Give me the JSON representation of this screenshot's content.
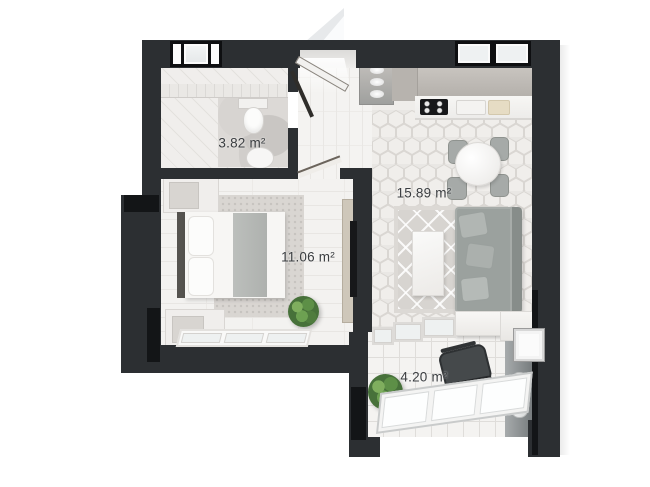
{
  "plan": {
    "type": "apartment-floor-plan",
    "rooms": [
      {
        "id": "bathroom",
        "area_label": "3.82 m²"
      },
      {
        "id": "kitchen-living",
        "area_label": "15.89 m²"
      },
      {
        "id": "bedroom",
        "area_label": "11.06 m²"
      },
      {
        "id": "balcony",
        "area_label": "4.20 m²"
      }
    ],
    "colors": {
      "wall": "#2c2f32",
      "wall_accent_black": "#131517",
      "floor_light": "#f2f1ef",
      "sofa_gray": "#9ba19e",
      "plant_green": "#4c7a3c",
      "label_text": "#3a3d40"
    },
    "furniture_icons": [
      "toilet",
      "bathroom-sink",
      "bathtub-ledge",
      "entrance-door",
      "hall-wardrobe",
      "kitchen-counter",
      "cooktop",
      "kitchen-sink",
      "cutting-board",
      "dining-table",
      "dining-chair",
      "sofa",
      "coffee-table",
      "area-rug",
      "bed",
      "pillow",
      "nightstand",
      "dresser",
      "tv",
      "potted-plant",
      "desk",
      "office-chair",
      "water-heater",
      "ac-unit",
      "window",
      "door-leaf"
    ]
  }
}
